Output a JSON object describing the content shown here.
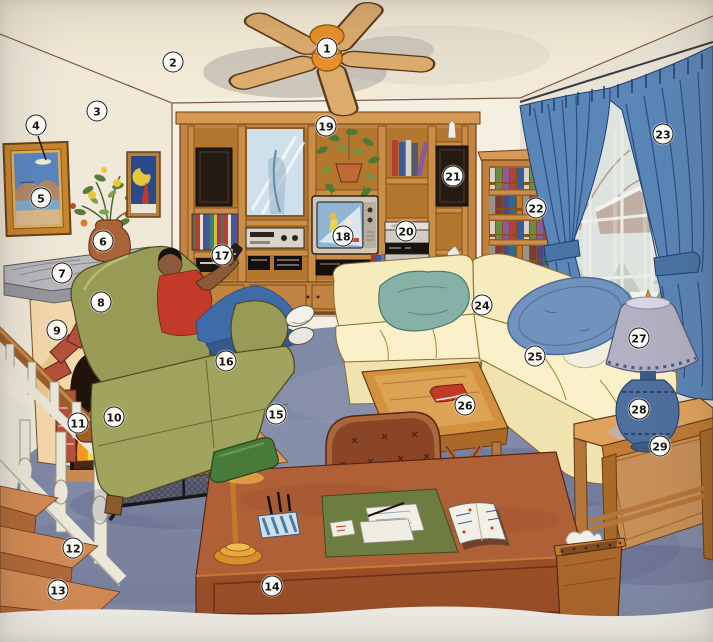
{
  "figure": {
    "kind": "picture-dictionary-illustration",
    "scene": "living-room"
  },
  "palette": {
    "page": "#efece3",
    "ceiling": "#f2e9d6",
    "wallLeft": "#f0e9da",
    "wallBack": "#f5efe2",
    "wallRight": "#e9e3d6",
    "carpet": "#8089a6",
    "woodUnit": "#c28442",
    "woodTrim": "#d49a55",
    "woodDark": "#6b3c12",
    "shelfBack": "#b3772f",
    "bookcaseWood": "#c08040",
    "curtain": "#5b86b8",
    "curtainDark": "#2c4f80",
    "sky": "#d4dcd6",
    "snow": "#eef1ec",
    "sofa": "#f6ebbd",
    "sofaSeat": "#faf1ca",
    "sofaFront": "#f1e3b0",
    "cushionTeal": "#86b1a6",
    "cushionBlue": "#7092bd",
    "lampShade": "#b3b0c3",
    "lampBase": "#4f6f9e",
    "olive": "#989b55",
    "oliveLight": "#a1a45e",
    "mantel": "#b9b8bc",
    "surround": "#f5d9ac",
    "brick": "#b5503c",
    "fire": "#f59a1f",
    "fireYellow": "#f8d44a",
    "opening": "#1f130c",
    "stairTread": "#d28b55",
    "stairFront": "#b06a38",
    "rail": "#9a5e2c",
    "baluster": "#ebe7da",
    "deskWood": "#b06036",
    "deskFront": "#9a4f28",
    "blotter": "#6d7d42",
    "chairBrown": "#8a4527",
    "chairWood": "#a9673a",
    "skin": "#8a5a3a",
    "shirt": "#c23a2a",
    "jeans": "#3f6ca8",
    "tvBody": "#cfc7b8",
    "tvScreen": "#8fb4d4",
    "dark": "#241a12",
    "paper": "#f2f0e6",
    "pageEdge": "#f2f0e9",
    "fanWood": "#dcab6e",
    "fanHub": "#e8902c"
  },
  "callouts": [
    {
      "n": 1,
      "x": 327,
      "y": 48,
      "name": "ceiling-fan"
    },
    {
      "n": 2,
      "x": 173,
      "y": 62,
      "name": "ceiling"
    },
    {
      "n": 3,
      "x": 97,
      "y": 111,
      "name": "wall"
    },
    {
      "n": 4,
      "x": 36,
      "y": 125,
      "name": "frame"
    },
    {
      "n": 5,
      "x": 41,
      "y": 198,
      "name": "painting"
    },
    {
      "n": 6,
      "x": 103,
      "y": 241,
      "name": "vase"
    },
    {
      "n": 7,
      "x": 62,
      "y": 273,
      "name": "mantel"
    },
    {
      "n": 8,
      "x": 101,
      "y": 302,
      "name": "fireplace"
    },
    {
      "n": 9,
      "x": 57,
      "y": 330,
      "name": "brick"
    },
    {
      "n": 10,
      "x": 114,
      "y": 417,
      "name": "fire-screen"
    },
    {
      "n": 11,
      "x": 78,
      "y": 423,
      "name": "firewood"
    },
    {
      "n": 12,
      "x": 73,
      "y": 548,
      "name": "banister"
    },
    {
      "n": 13,
      "x": 58,
      "y": 590,
      "name": "staircase"
    },
    {
      "n": 14,
      "x": 272,
      "y": 586,
      "name": "desk"
    },
    {
      "n": 15,
      "x": 276,
      "y": 414,
      "name": "carpet"
    },
    {
      "n": 16,
      "x": 226,
      "y": 361,
      "name": "armchair"
    },
    {
      "n": 17,
      "x": 222,
      "y": 255,
      "name": "remote-control"
    },
    {
      "n": 18,
      "x": 343,
      "y": 236,
      "name": "television"
    },
    {
      "n": 19,
      "x": 326,
      "y": 126,
      "name": "wall-unit"
    },
    {
      "n": 20,
      "x": 406,
      "y": 231,
      "name": "stereo-system"
    },
    {
      "n": 21,
      "x": 453,
      "y": 176,
      "name": "speaker"
    },
    {
      "n": 22,
      "x": 536,
      "y": 208,
      "name": "bookcase"
    },
    {
      "n": 23,
      "x": 663,
      "y": 134,
      "name": "drapes"
    },
    {
      "n": 24,
      "x": 482,
      "y": 305,
      "name": "throw-pillow"
    },
    {
      "n": 25,
      "x": 535,
      "y": 356,
      "name": "sofa"
    },
    {
      "n": 26,
      "x": 465,
      "y": 405,
      "name": "coffee-table"
    },
    {
      "n": 27,
      "x": 639,
      "y": 338,
      "name": "lampshade"
    },
    {
      "n": 28,
      "x": 639,
      "y": 409,
      "name": "lamp"
    },
    {
      "n": 29,
      "x": 660,
      "y": 446,
      "name": "end-table"
    }
  ]
}
